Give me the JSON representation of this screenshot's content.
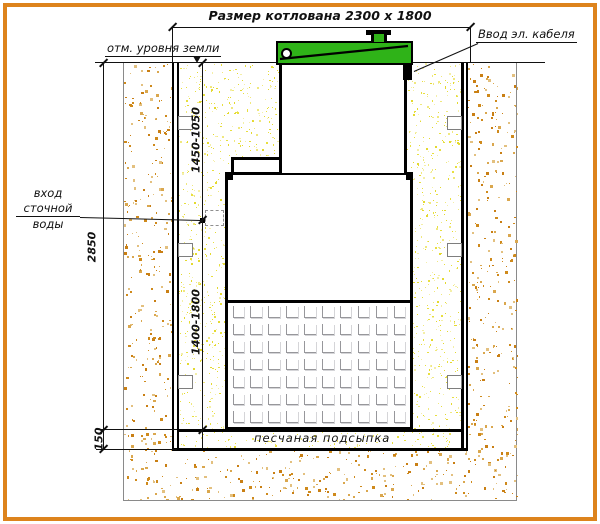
{
  "labels": {
    "pit_size": "Размер котлована 2300 х 1800",
    "ground_level": "отм. уровня земли",
    "cable_entry": "Ввод эл. кабеля",
    "wastewater_inlet": [
      "вход",
      "сточной",
      "воды"
    ],
    "sand_bedding": "песчаная подсыпка"
  },
  "dimensions": {
    "total_depth_mm": "2850",
    "upper_depth_range_mm": "1450-1050",
    "lower_depth_range_mm": "1400-1800",
    "bedding_thickness_mm": "150"
  },
  "colors": {
    "frame": "#dd831c",
    "lid_green": "#2fb318",
    "ground_speckle": "#cf8a1c",
    "sand_speckle": "#e8df3f"
  }
}
